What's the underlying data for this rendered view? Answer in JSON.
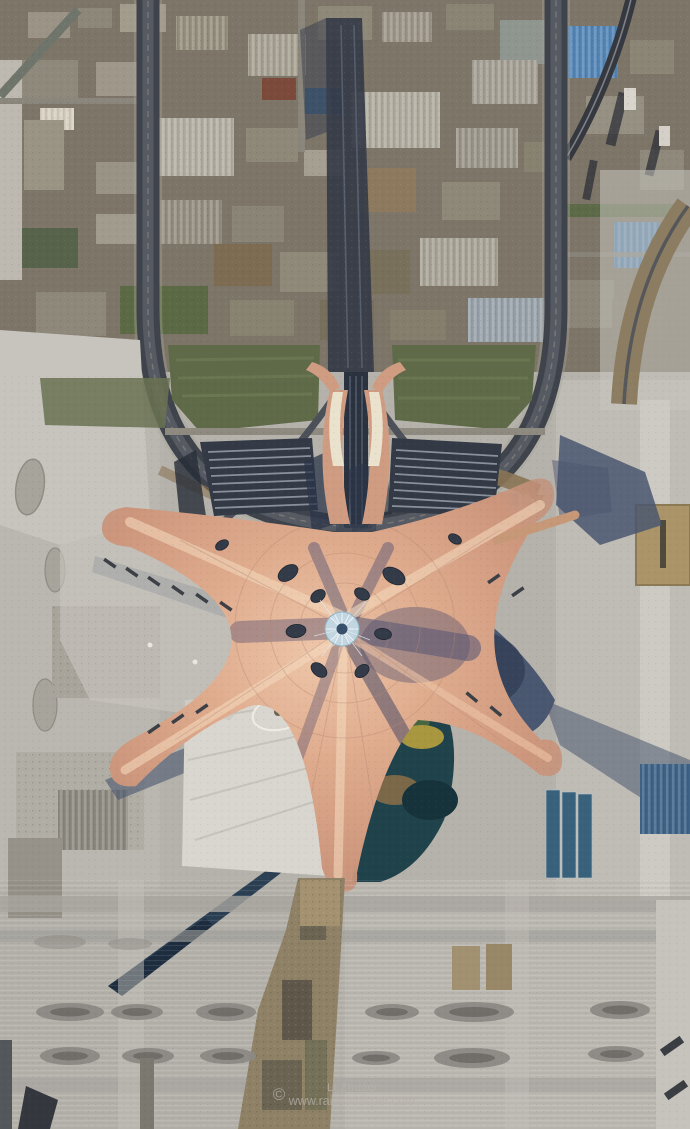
{
  "meta": {
    "type": "aerial-photograph",
    "subject": "Top-down aerial view of Beijing Daxing International Airport starfish terminal under construction",
    "width_px": 690,
    "height_px": 1129
  },
  "watermark": {
    "symbol": "©",
    "line1": "Li Zhuoqi",
    "line2": "www.rainywhisper.com"
  },
  "palette": {
    "apron": "#b5b2ab",
    "apron_light": "#c7c4bd",
    "apron_pale": "#d9d6cf",
    "urban_base": "#847d6d",
    "roof_lit": "#e2b092",
    "roof_highlight": "#f3d7bb",
    "roof_mid": "#cf9c82",
    "roof_deep": "#b3826f",
    "shadow_blue": "#4a5770",
    "shadow_deep": "#323e56",
    "loop_road": "#3f434b",
    "lawn": "#5f6a48",
    "parking_dark": "#333a45",
    "parking_row": "#98a0aa",
    "garden_teal": "#1f424b",
    "dirt_brown": "#8f8166",
    "blue_roof": "#3f6488",
    "blue_roof_bright": "#5587b8",
    "tan": "#ab9468",
    "skylight_web": "#c2d6e2",
    "oval_dark": "#333b49",
    "cream": "#eae2cd",
    "watermark": "#b7b2a9"
  }
}
